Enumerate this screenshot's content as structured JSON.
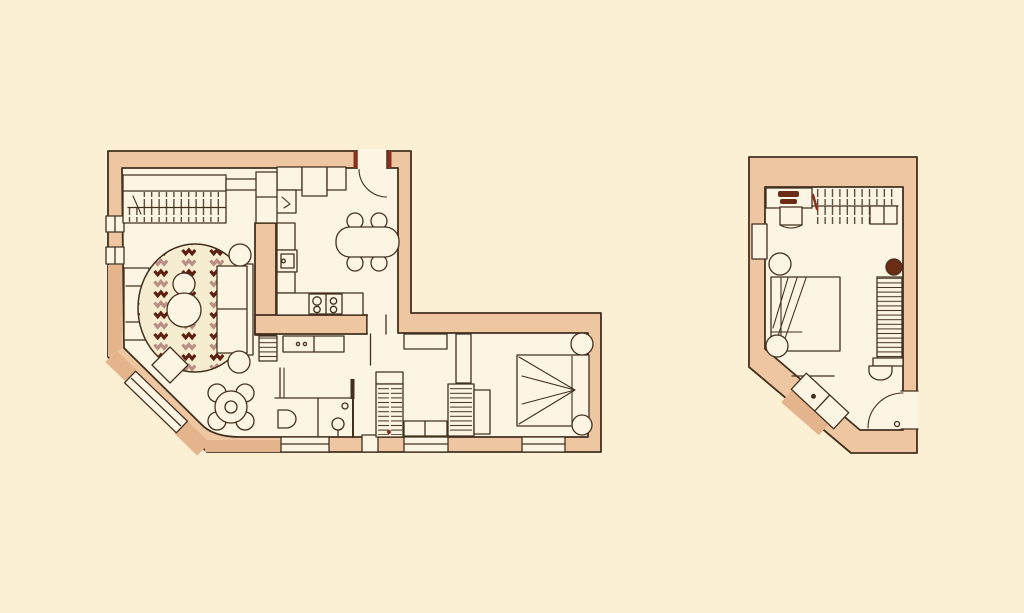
{
  "document": {
    "type": "hand-drawn architectural floor plan, watercolor style",
    "visible_text": "none",
    "sheets": 2
  },
  "colors": {
    "background": "#fbefd4",
    "floor": "#fdf5e3",
    "wall": "#eec7a2",
    "wall_shadow": "#e4b48d",
    "ink": "#42301f",
    "rug_base": "#f6ecd0",
    "rug_dark": "#5d1f10",
    "rug_mauve": "#b98e84",
    "stove_dark": "#6a2c15",
    "jamb_red": "#8c2f1c"
  },
  "plans": {
    "main": {
      "label": "main apartment floor plan (L-shaped, chamfered corner)",
      "rooms": [
        "living-room",
        "kitchen-dining",
        "hallway",
        "bathroom",
        "bedroom"
      ],
      "living_room": [
        "wall-shelf-with-clothes-rack",
        "armchair",
        "striped-round-rug",
        "nesting-coffee-tables",
        "sofa",
        "two-round-side-tables",
        "corner-square-table",
        "small-round-table-with-chairs",
        "radiator"
      ],
      "kitchen": [
        "entry-door-with-swing",
        "wall-cabinets",
        "tall-cabinet",
        "sink-counter",
        "hob-with-four-burners",
        "oval-dining-table",
        "four-round-chairs"
      ],
      "hallway": [
        "console-sideboard",
        "interior-door"
      ],
      "bathroom": [
        "toilet",
        "pedestal-washbasin",
        "shower-area"
      ],
      "bedroom": [
        "double-bed-with-folded-blanket",
        "two-round-nightstands",
        "hatched-wardrobe-1",
        "hatched-wardrobe-2",
        "low-dresser",
        "tall-cupboard",
        "wall-shelf"
      ],
      "windows": [
        "left-wall-window-1",
        "left-wall-window-2",
        "diagonal-corner-window",
        "bottom-window-1",
        "bottom-window-2",
        "bottom-window-3"
      ]
    },
    "annex": {
      "label": "separate studio room floor plan (chamfered corner)",
      "furniture": [
        "desk-with-dark-accessories",
        "desk-chair",
        "clothes-rack",
        "wall-niche-radiator",
        "double-bed-with-folded-blanket",
        "two-round-nightstands",
        "dark-stove-circle",
        "tall-hatched-radiator-rack",
        "small-washbasin",
        "diagonal-storage-bench",
        "entry-door-with-swing"
      ]
    }
  }
}
